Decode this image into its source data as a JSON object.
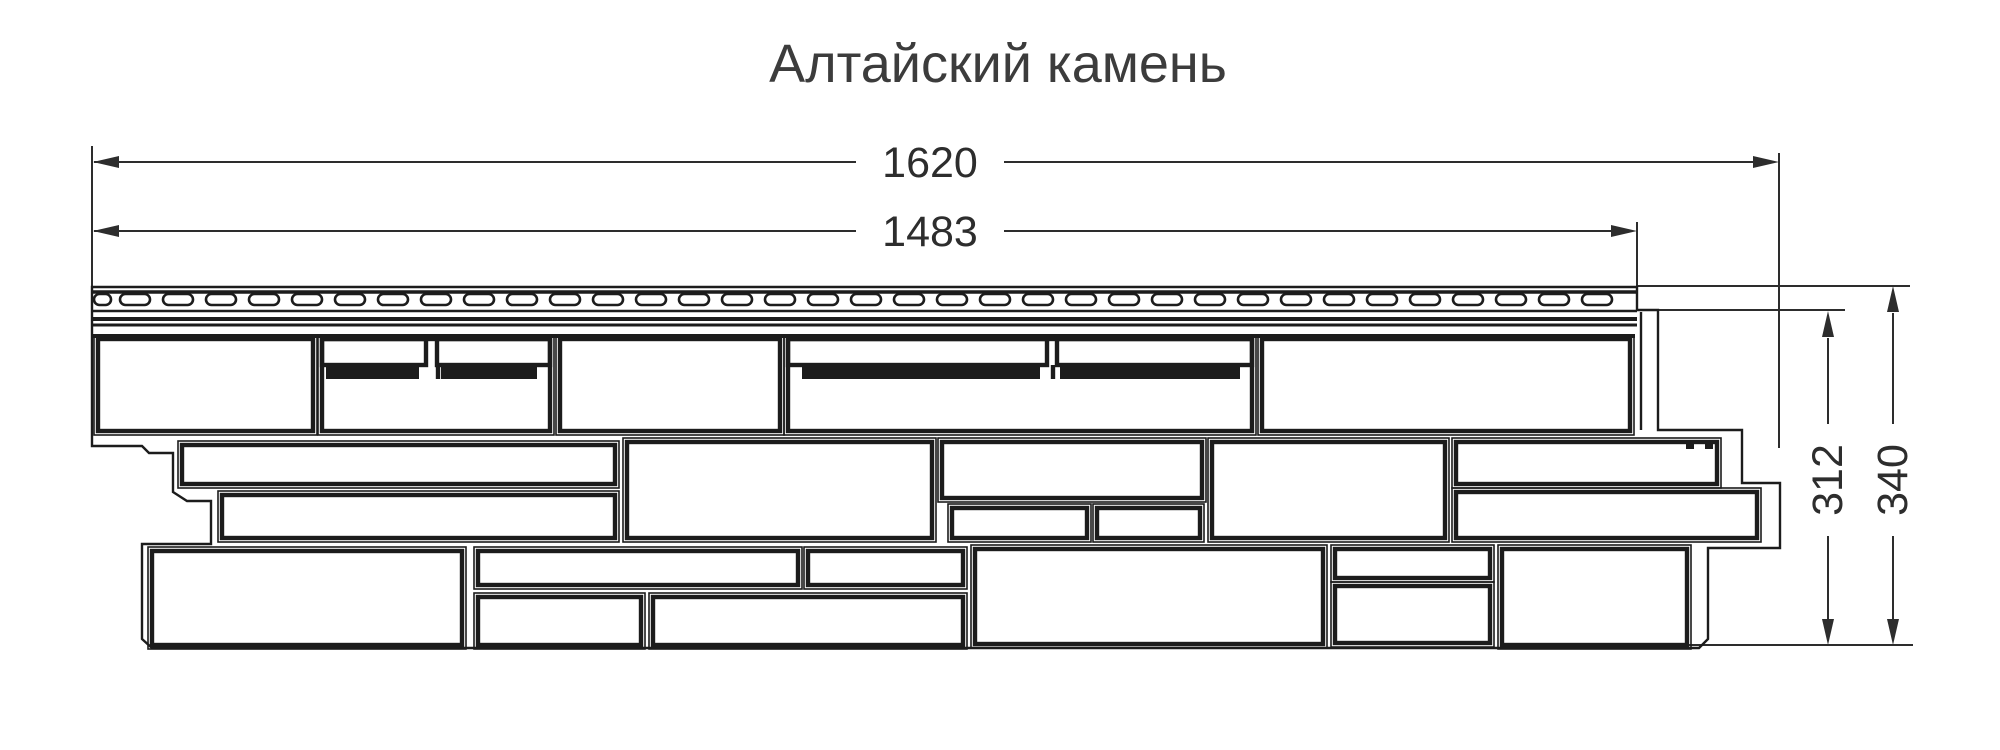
{
  "title": "Алтайский камень",
  "dimensions": {
    "total_length": "1620",
    "nominal_length": "1483",
    "exposure_height": "312",
    "total_height": "340"
  },
  "colors": {
    "background": "#ffffff",
    "drawing_line": "#1c1c1c",
    "dimension_line": "#2d2d2d",
    "title_text": "#3c3c3c"
  }
}
